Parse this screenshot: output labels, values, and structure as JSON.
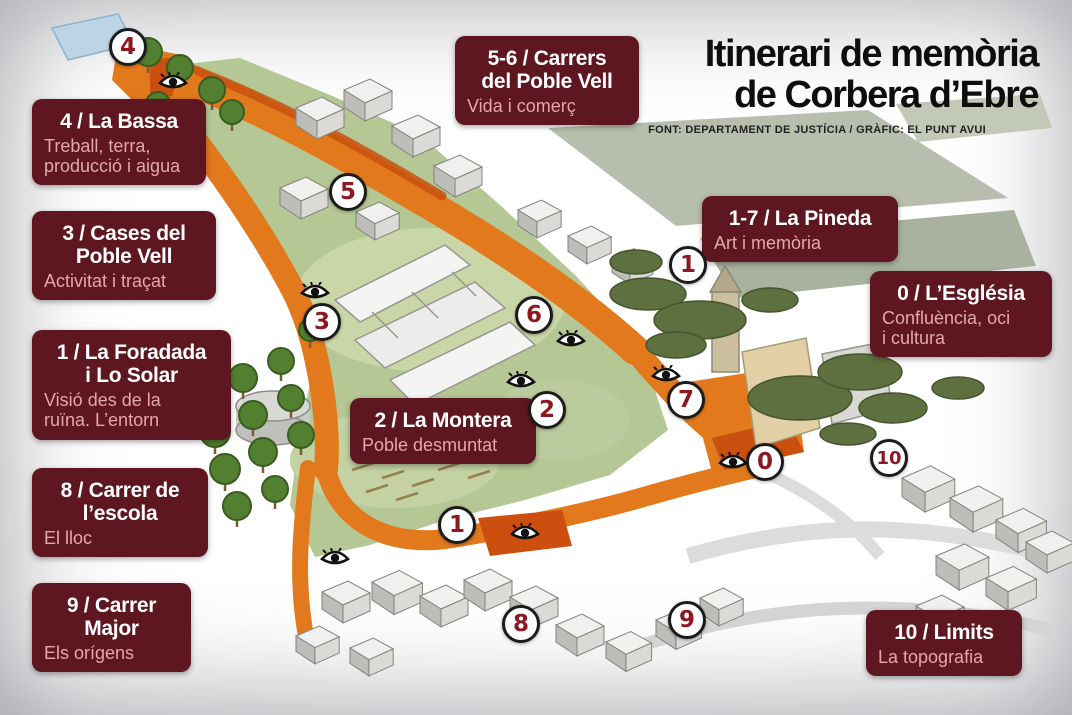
{
  "title": {
    "line1": "Itinerari de memòria",
    "line2": "de Corbera d’Ebre",
    "source": "FONT: DEPARTAMENT DE JUSTÍCIA / GRÀFIC: EL PUNT AVUI"
  },
  "labels": [
    {
      "id": "5-6",
      "title": "5-6 / Carrers\ndel Poble Vell",
      "subtitle": "Vida i comerç"
    },
    {
      "id": "4",
      "title": "4 / La Bassa",
      "subtitle": "Treball, terra,\nproducció i aigua"
    },
    {
      "id": "3",
      "title": "3 / Cases del\nPoble Vell",
      "subtitle": "Activitat i traçat"
    },
    {
      "id": "1",
      "title": "1 / La Foradada\ni Lo Solar",
      "subtitle": "Visió des de la\nruïna. L’entorn"
    },
    {
      "id": "8",
      "title": "8 / Carrer de\nl’escola",
      "subtitle": "El lloc"
    },
    {
      "id": "9",
      "title": "9 / Carrer\nMajor",
      "subtitle": "Els orígens"
    },
    {
      "id": "1-7",
      "title": "1-7 / La Pineda",
      "subtitle": "Art i memòria"
    },
    {
      "id": "0",
      "title": "0 / L’Església",
      "subtitle": "Confluència, oci\ni cultura"
    },
    {
      "id": "2",
      "title": "2 / La Montera",
      "subtitle": "Poble desmuntat"
    },
    {
      "id": "10",
      "title": "10 / Limits",
      "subtitle": "La topografia"
    }
  ],
  "markers": [
    {
      "number": "4"
    },
    {
      "number": "5"
    },
    {
      "number": "3"
    },
    {
      "number": "6"
    },
    {
      "number": "1"
    },
    {
      "number": "2"
    },
    {
      "number": "7"
    },
    {
      "number": "0"
    },
    {
      "number": "10"
    },
    {
      "number": "1"
    },
    {
      "number": "8"
    },
    {
      "number": "9"
    }
  ],
  "icons": {
    "viewpoint": "eye-icon"
  },
  "colors": {
    "label_box": "#5e1620",
    "label_title": "#ffffff",
    "label_subtitle": "#e2a8ac",
    "marker_number": "#8c1822",
    "route_orange": "#e2791c",
    "route_dark": "#c9500f",
    "field_green": "#b5c795"
  }
}
